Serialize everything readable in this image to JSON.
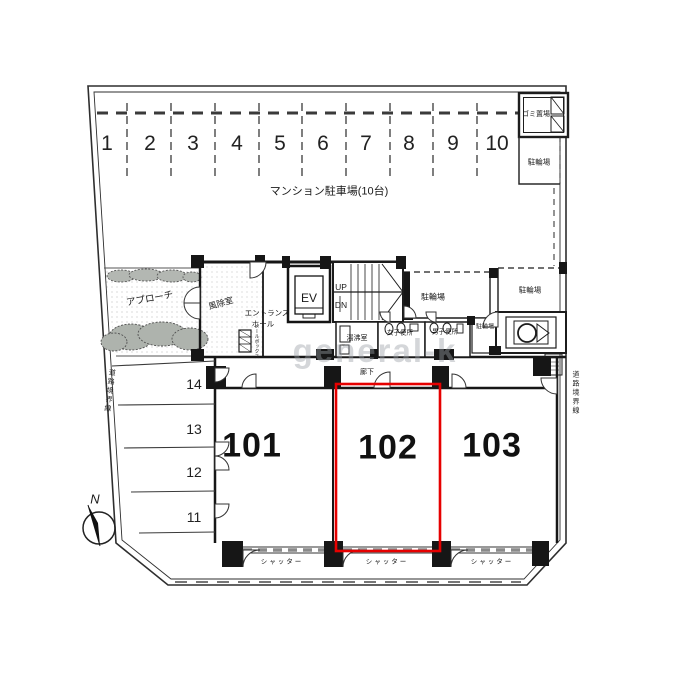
{
  "plan": {
    "parking_area_label": "マンション駐車場(10台)",
    "parking_spaces": [
      "1",
      "2",
      "3",
      "4",
      "5",
      "6",
      "7",
      "8",
      "9",
      "10"
    ],
    "side_spaces": [
      "14",
      "13",
      "12",
      "11"
    ],
    "units": [
      {
        "number": "101",
        "highlighted": false
      },
      {
        "number": "102",
        "highlighted": true
      },
      {
        "number": "103",
        "highlighted": false
      }
    ],
    "labels": {
      "garbage_area": "ゴミ置場",
      "bicycle_parking": "駐輪場",
      "approach": "アプローチ",
      "vestibule": "風除室",
      "entrance_hall_line1": "エントランス",
      "entrance_hall_line2": "ホール",
      "mailbox": "メールボックス",
      "elevator": "EV",
      "up": "UP",
      "down": "DN",
      "kitchenette": "湯沸室",
      "womens_toilet": "女子便所",
      "mens_toilet": "男子便所",
      "corridor": "廊下",
      "shutter": "シャッター",
      "road_boundary_line": "道路境界線",
      "north": "N"
    },
    "watermark": "general-k",
    "colors": {
      "highlight": "#e60000",
      "wall": "#161616"
    }
  }
}
